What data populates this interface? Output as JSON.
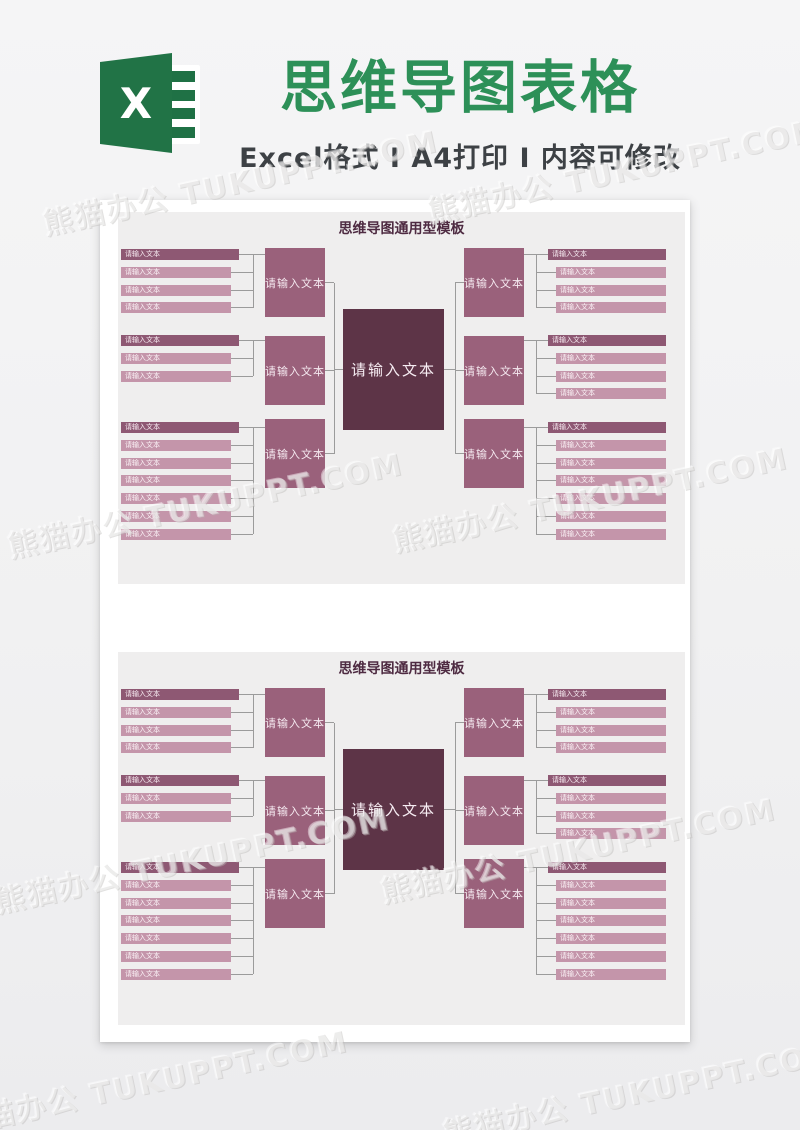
{
  "header": {
    "title": "思维导图表格",
    "subtitle": "Excel格式 Ⅰ A4打印 Ⅰ 内容可修改",
    "title_color": "#2d9058",
    "excel_icon": {
      "letter": "X",
      "green": "#217346"
    }
  },
  "watermark": {
    "text": "熊猫办公 TUKUPPT.COM"
  },
  "colors": {
    "page_background": "#f1f1f2",
    "sheet_background": "#ffffff",
    "panel_background": "#efeeee",
    "page_title": "#4e2b42",
    "central_node": "#5d3447",
    "branch_node": "#9a617b",
    "leaf_header": "#8e5873",
    "leaf_item": "#c495aa",
    "connector": "#9b9b9b"
  },
  "pages": [
    {
      "title": "思维导图通用型模板",
      "central_label": "请输入文本",
      "branch_label": "请输入文本",
      "leaf_label": "请输入文本",
      "left_branches": [
        {
          "leaves": 4
        },
        {
          "leaves": 3
        },
        {
          "leaves": 7
        }
      ],
      "right_branches": [
        {
          "leaves": 4
        },
        {
          "leaves": 4
        },
        {
          "leaves": 7
        }
      ]
    },
    {
      "title": "思维导图通用型模板",
      "central_label": "请输入文本",
      "branch_label": "请输入文本",
      "leaf_label": "请输入文本",
      "left_branches": [
        {
          "leaves": 4
        },
        {
          "leaves": 3
        },
        {
          "leaves": 7
        }
      ],
      "right_branches": [
        {
          "leaves": 4
        },
        {
          "leaves": 4
        },
        {
          "leaves": 7
        }
      ]
    }
  ]
}
